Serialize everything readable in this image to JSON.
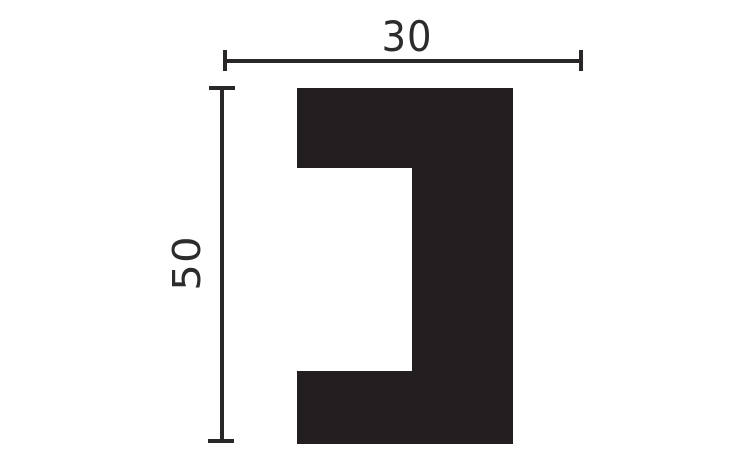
{
  "diagram": {
    "title": "profile-cross-section-drawing",
    "shape": {
      "description": "black C-shaped (bracket) molding profile cross-section with rectangular notch open to the left"
    },
    "dimensions": {
      "width": {
        "value": "30",
        "orientation": "horizontal",
        "position": "top"
      },
      "height": {
        "value": "50",
        "orientation": "vertical-rotated-90",
        "position": "left"
      }
    },
    "colors": {
      "background": "#ffffff",
      "shape_fill": "#231f20",
      "dimension_line": "#2a2728",
      "label_text": "#2e2b2c"
    }
  }
}
